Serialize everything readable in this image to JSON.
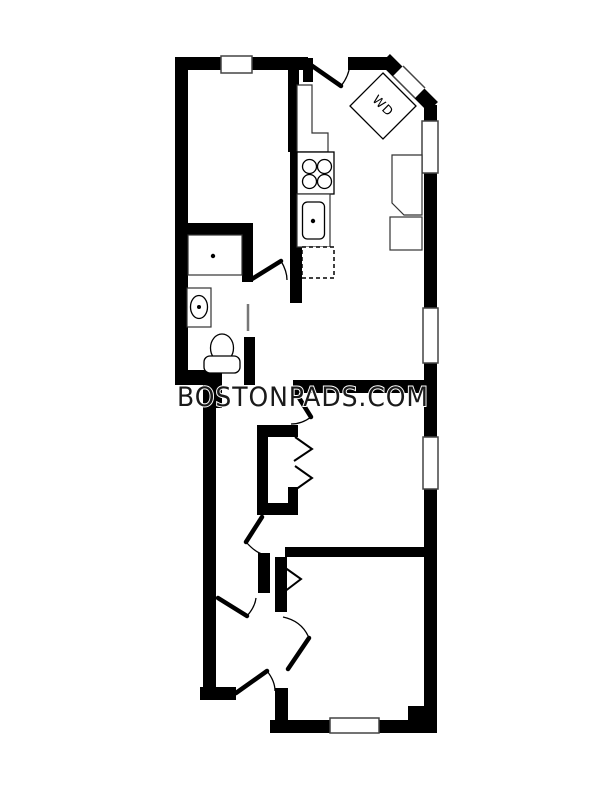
{
  "document": {
    "type": "apartment-floor-plan",
    "watermark": "BOSTONPADS.COM"
  },
  "labels": {
    "washer_dryer": "WD"
  },
  "colors": {
    "walls": "#000000",
    "background": "#ffffff",
    "watermark_text": "#1a1a1a"
  },
  "fixtures": [
    "washer-dryer-unit",
    "kitchen-counter",
    "stove-four-burners",
    "kitchen-sink",
    "dishwasher-dashed",
    "shower",
    "vanity-sink",
    "toilet",
    "chimney-alcove",
    "radiator"
  ],
  "features": {
    "windows_visible": 7,
    "swing_doors_visible": 8,
    "bifold_closet_panels": 3
  }
}
